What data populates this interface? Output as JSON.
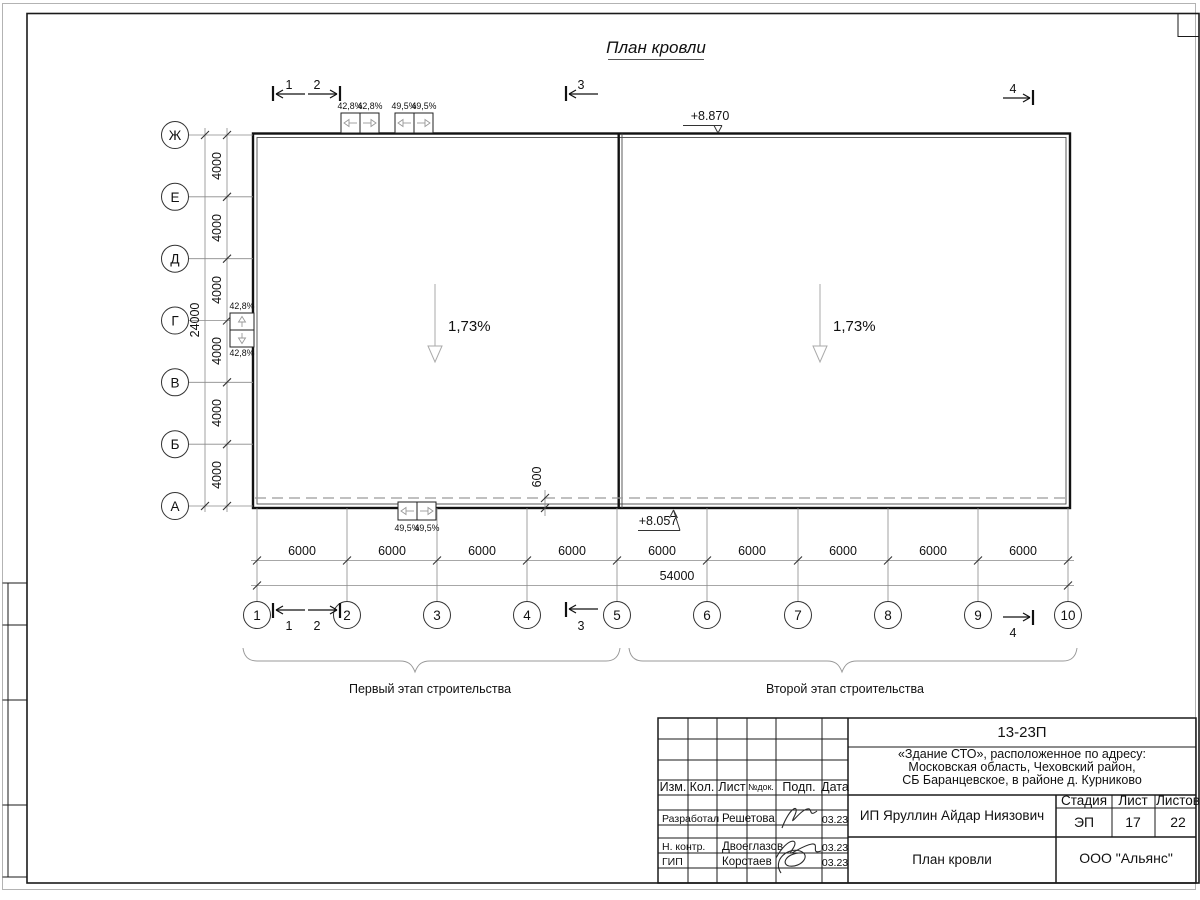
{
  "sheet": {
    "title": "План кровли"
  },
  "plan": {
    "slope_label": "1,73%",
    "elevation_top": "+8.870",
    "elevation_bottom": "+8.057",
    "axes_left": [
      "Ж",
      "Е",
      "Д",
      "Г",
      "В",
      "Б",
      "А"
    ],
    "axes_bottom": [
      "1",
      "2",
      "3",
      "4",
      "5",
      "6",
      "7",
      "8",
      "9",
      "10"
    ],
    "section_marks": [
      "1",
      "2",
      "3",
      "4"
    ],
    "dims": {
      "bay_v": "4000",
      "total_v": "24000",
      "bay_h": "6000",
      "total_h": "54000",
      "parapet": "600"
    },
    "drain_slopes": {
      "s428": "42,8%",
      "s495": "49,5%"
    },
    "stage_left": "Первый этап строительства",
    "stage_right": "Второй этап строительства"
  },
  "titleblock": {
    "doc_number": "13-23П",
    "project_line1": "«Здание СТО», расположенное по адресу:",
    "project_line2": "Московская область, Чеховский район,",
    "project_line3": "СБ Баранцевское, в районе д. Курниково",
    "header": {
      "izm": "Изм.",
      "kol": "Кол.",
      "list": "Лист",
      "ndok": "№док.",
      "podp": "Подп.",
      "data": "Дата"
    },
    "rows": [
      {
        "role": "Разработал",
        "name": "Решетова",
        "date": "03.23"
      },
      {
        "role": "Н. контр.",
        "name": "Двоеглазов",
        "date": "03.23"
      },
      {
        "role": "ГИП",
        "name": "Коротаев",
        "date": "03.23"
      }
    ],
    "client": "ИП Яруллин Айдар Ниязович",
    "stage_label": "Стадия",
    "sheet_label": "Лист",
    "sheets_label": "Листов",
    "stage_value": "ЭП",
    "sheet_value": "17",
    "sheets_value": "22",
    "drawing_name": "План кровли",
    "company": "ООО \"Альянс\""
  }
}
